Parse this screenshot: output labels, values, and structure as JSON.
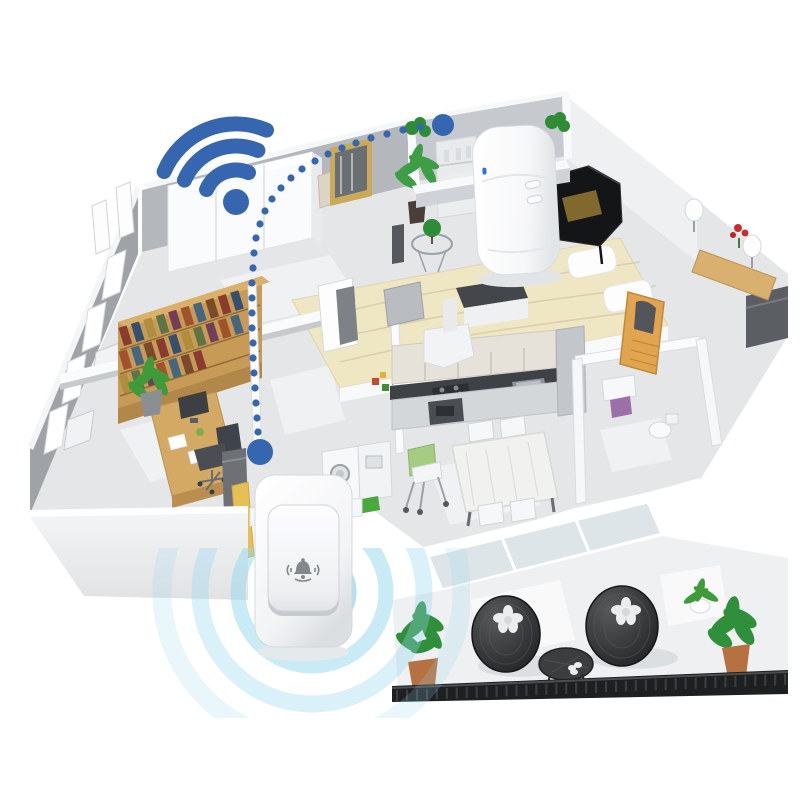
{
  "meta": {
    "title": "Wireless doorbell home coverage illustration",
    "background": "#ffffff",
    "description": "Isometric cutaway floor plan of an apartment showing a wireless doorbell push button transmitting a signal to a plug-in receiver"
  },
  "palette": {
    "signal_blue": "#3666b0",
    "wave_cyan": "#93d7ec",
    "wall_grey": "#b4b8bc",
    "wall_grey_dark": "#9fa3a8",
    "wall_white": "#f6f7f8",
    "floor_grey": "#e4e6e8",
    "wood": "#c79a55",
    "wood_light": "#dbb069",
    "accent_yellow": "#e7c055",
    "leaf_green": "#2e8b36",
    "railing_dark": "#1d1f21",
    "door_orange": "#e2a44f"
  },
  "wifi": {
    "icon": "wifi-icon",
    "color": "#3666b0",
    "arc_count": 3
  },
  "signal_path": {
    "color": "#3666b0",
    "dot_radius": 3.6,
    "endpoint_radius_top": 11,
    "endpoint_radius_bottom": 13,
    "points": [
      [
        443,
        125
      ],
      [
        420,
        127
      ],
      [
        403,
        130
      ],
      [
        387,
        134
      ],
      [
        371,
        138
      ],
      [
        356,
        143
      ],
      [
        342,
        148
      ],
      [
        328,
        154
      ],
      [
        315,
        161
      ],
      [
        302,
        169
      ],
      [
        291,
        178
      ],
      [
        281,
        188
      ],
      [
        272,
        199
      ],
      [
        265,
        211
      ],
      [
        260,
        224
      ],
      [
        256,
        238
      ],
      [
        254,
        253
      ],
      [
        253,
        268
      ],
      [
        252,
        283
      ],
      [
        252,
        298
      ],
      [
        252,
        313
      ],
      [
        252,
        328
      ],
      [
        253,
        343
      ],
      [
        253,
        358
      ],
      [
        254,
        373
      ],
      [
        255,
        388
      ],
      [
        256,
        403
      ],
      [
        257,
        418
      ],
      [
        258,
        432
      ],
      [
        260,
        452
      ]
    ]
  },
  "sound_waves": {
    "color": "#93d7ec",
    "center": [
      312,
      592
    ],
    "ring_radii": [
      38,
      74,
      112,
      150
    ],
    "ring_opacity": [
      0.75,
      0.5,
      0.34,
      0.2
    ]
  },
  "doorbell_button": {
    "icon": "bell-icon",
    "body_color": "#ffffff",
    "icon_color": "#82888e"
  },
  "receiver": {
    "body_color": "#ffffff",
    "led_color": "#2f6fd6",
    "side_buttons": 2
  },
  "house": {
    "rooms": [
      "bedroom",
      "walk-in-room",
      "music-room",
      "home-office",
      "hallway",
      "kitchen",
      "dining-room",
      "bathroom",
      "balcony"
    ]
  },
  "bookshelf": {
    "book_colors": [
      "#8a3b2f",
      "#34506e",
      "#b08c3e",
      "#5e7447",
      "#733d5a",
      "#a0522d",
      "#46657f",
      "#7a4a2a"
    ],
    "rows": [
      10,
      10,
      7
    ]
  },
  "railing": {
    "posts": 40,
    "color": "#1d1f21"
  }
}
